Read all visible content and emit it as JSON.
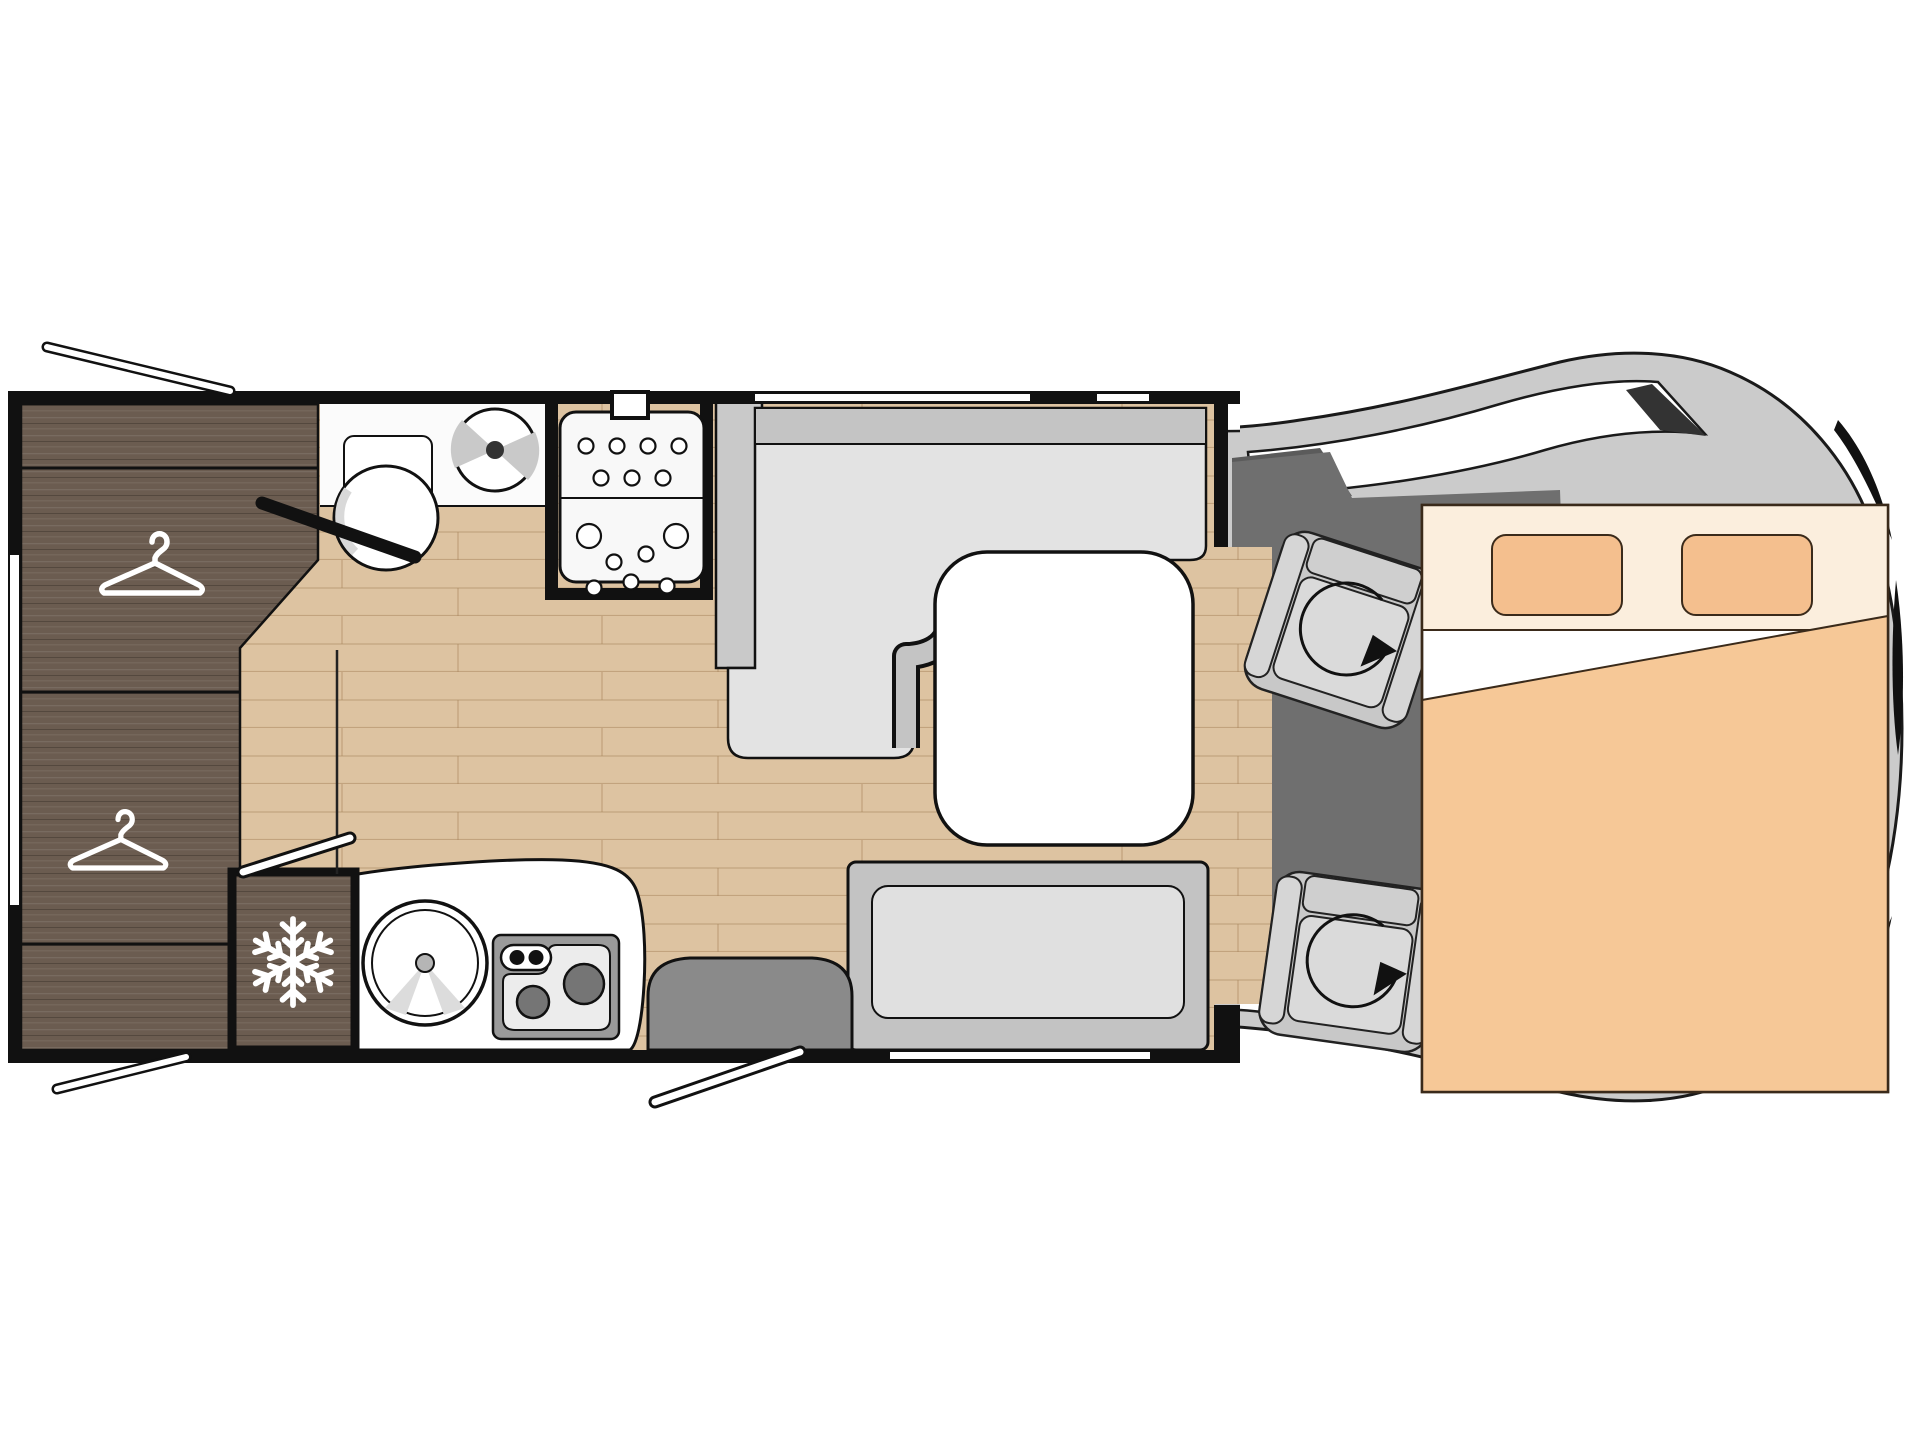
{
  "diagram": {
    "kind": "motorhome-floorplan-top-view",
    "orientation": "cab-to-the-right",
    "visible_text": []
  },
  "palette": {
    "wall": "#111111",
    "floor_wood": "#ddc3a1",
    "plank_line": "#a8835c",
    "dark_wood": "#6b5c50",
    "bench_seat": "#e3e3e3",
    "bench_back": "#c4c4c4",
    "partition": "#c9c9c9",
    "table": "#ffffff",
    "fixture": "#ffffff",
    "cab_body": "#cbcbcb",
    "cab_floor": "#6f6f6f",
    "step": "#8a8a8a",
    "bed_blanket": "#f6c897",
    "bed_head": "#fbeedd",
    "pillow": "#f4bf8e",
    "burner": "#757575"
  },
  "icons": {
    "hanger": "clothes-hanger (wardrobe)",
    "snowflake": "snowflake (fridge)",
    "fan": "roof vent fan (bathroom)",
    "rotate_arrow": "seat swivel arrow",
    "shower_jets": "dot pattern (shower tray)"
  },
  "fixtures": [
    "rear-wardrobe",
    "hanging-rail-upper",
    "hanging-rail-lower",
    "bathroom-toilet",
    "bathroom-cistern",
    "bathroom-vent-fan",
    "shower-cabin",
    "fridge",
    "kitchen-counter",
    "kitchen-sink",
    "two-burner-stove",
    "entry-step",
    "entry-door",
    "l-shaped-dinette-bench",
    "dinette-table",
    "side-bench",
    "driver-swivel-seat",
    "passenger-swivel-seat",
    "drop-down-double-bed",
    "pillow-left",
    "pillow-right",
    "opening-window-top-rear",
    "opening-window-bottom-rear",
    "rear-window"
  ]
}
